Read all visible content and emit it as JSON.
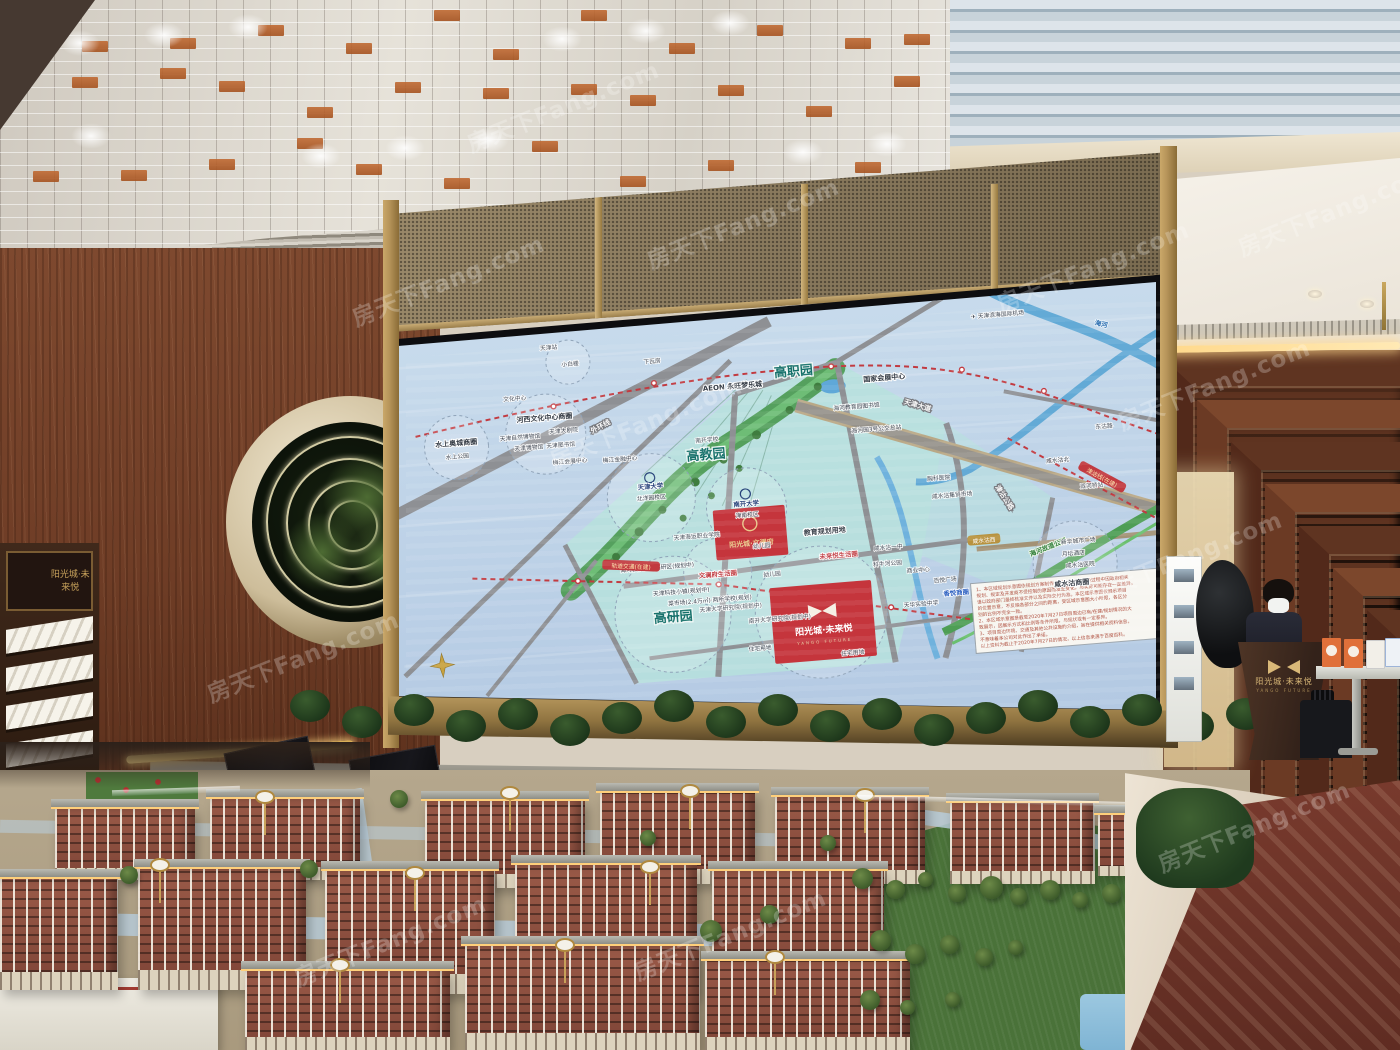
{
  "watermark": {
    "text": "房天下Fang.com"
  },
  "brand": {
    "podium": "阳光城·未来悦",
    "podium_sub": "YANGO FUTURE",
    "rack_plaque": "阳光城·未来悦"
  },
  "screen_map": {
    "projects": {
      "p1": {
        "name": "阳光城·文澜府"
      },
      "p2": {
        "name": "阳光城·未来悦",
        "sub": "YANGO FUTURE"
      }
    },
    "labels": [
      {
        "s": "天津站",
        "x": 150,
        "y": 16,
        "t": "ls"
      },
      {
        "s": "小白楼",
        "x": 170,
        "y": 34,
        "t": "ls"
      },
      {
        "s": "下瓦房",
        "x": 252,
        "y": 38,
        "t": "ls"
      },
      {
        "s": "文化中心",
        "x": 112,
        "y": 64,
        "t": "ls"
      },
      {
        "s": "水上奥城商圈",
        "x": 50,
        "y": 104,
        "t": "ln"
      },
      {
        "s": "水上公园",
        "x": 50,
        "y": 117,
        "t": "ls"
      },
      {
        "s": "河西文化中心商圈",
        "x": 140,
        "y": 86,
        "t": "ln"
      },
      {
        "s": "天津自然博物馆",
        "x": 114,
        "y": 103,
        "t": "ls"
      },
      {
        "s": "天津大剧院",
        "x": 158,
        "y": 100,
        "t": "ls"
      },
      {
        "s": "天津博物馆",
        "x": 122,
        "y": 114,
        "t": "ls"
      },
      {
        "s": "天津图书馆",
        "x": 154,
        "y": 114,
        "t": "ls"
      },
      {
        "s": "梅江会展中心",
        "x": 162,
        "y": 131,
        "t": "ls"
      },
      {
        "s": "梅江金融中心",
        "x": 212,
        "y": 133,
        "t": "ls"
      },
      {
        "s": "外环线",
        "x": 196,
        "y": 99,
        "t": "lroad",
        "r": -23
      },
      {
        "s": "AEON 永旺梦乐城",
        "x": 330,
        "y": 70,
        "t": "ln"
      },
      {
        "s": "高职园",
        "x": 392,
        "y": 62,
        "t": "lz"
      },
      {
        "s": "高教园",
        "x": 298,
        "y": 138,
        "t": "lz"
      },
      {
        "s": "高研园",
        "x": 252,
        "y": 297,
        "t": "lz"
      },
      {
        "s": "✈ 天津滨海国际机场",
        "x": 600,
        "y": 20,
        "t": "ls"
      },
      {
        "s": "国家会展中心",
        "x": 482,
        "y": 74,
        "t": "ln"
      },
      {
        "s": "海河教育园图书馆",
        "x": 452,
        "y": 100,
        "t": "ls"
      },
      {
        "s": "海河园3号公交总站",
        "x": 470,
        "y": 124,
        "t": "ls"
      },
      {
        "s": "天津大道",
        "x": 512,
        "y": 104,
        "t": "lroad",
        "r": 21
      },
      {
        "s": "海河",
        "x": 702,
        "y": 38,
        "t": "lriv",
        "r": 18
      },
      {
        "s": "东沽路",
        "x": 697,
        "y": 140,
        "t": "ls"
      },
      {
        "s": "咸水沽北",
        "x": 648,
        "y": 170,
        "t": "ls"
      },
      {
        "s": "双河桥站",
        "x": 680,
        "y": 198,
        "t": "ls"
      },
      {
        "s": "津沽公路",
        "x": 590,
        "y": 202,
        "t": "lroad",
        "r": 62
      },
      {
        "s": "海河故道公园",
        "x": 632,
        "y": 256,
        "t": "lg",
        "r": -17
      },
      {
        "s": "天津大学",
        "x": 240,
        "y": 163,
        "t": "lu"
      },
      {
        "s": "北洋园校区",
        "x": 240,
        "y": 174,
        "t": "ls"
      },
      {
        "s": "南开大学",
        "x": 334,
        "y": 188,
        "t": "lu"
      },
      {
        "s": "津南校区",
        "x": 334,
        "y": 199,
        "t": "ls"
      },
      {
        "s": "南开学校",
        "x": 300,
        "y": 121,
        "t": "ls"
      },
      {
        "s": "天津海运职业学院",
        "x": 282,
        "y": 216,
        "t": "ls"
      },
      {
        "s": "胸科医院",
        "x": 528,
        "y": 178,
        "t": "ls"
      },
      {
        "s": "咸水沽集贸市场",
        "x": 540,
        "y": 196,
        "t": "ls"
      },
      {
        "s": "海河教育园区高研区(规划中)",
        "x": 240,
        "y": 244,
        "t": "ls"
      },
      {
        "s": "天津科技小镇(规划中)",
        "x": 262,
        "y": 270,
        "t": "ls"
      },
      {
        "s": "天津大学研究院(规划中)",
        "x": 310,
        "y": 290,
        "t": "ls"
      },
      {
        "s": "南开大学研究院(规划中)",
        "x": 358,
        "y": 305,
        "t": "ls"
      },
      {
        "s": "文澜府生活圈",
        "x": 300,
        "y": 256,
        "t": "lr"
      },
      {
        "s": "幼儿园",
        "x": 346,
        "y": 231,
        "t": "ls"
      },
      {
        "s": "幼儿园",
        "x": 354,
        "y": 260,
        "t": "ls"
      },
      {
        "s": "教育规划用地",
        "x": 410,
        "y": 222,
        "t": "ln"
      },
      {
        "s": "未来悦生活圈",
        "x": 422,
        "y": 247,
        "t": "lr"
      },
      {
        "s": "菜市场(2.4万㎡)·两所学校(规划)",
        "x": 290,
        "y": 281,
        "t": "ls"
      },
      {
        "s": "住宅用地",
        "x": 336,
        "y": 333,
        "t": "ls"
      },
      {
        "s": "住宅用地",
        "x": 428,
        "y": 345,
        "t": "ls"
      },
      {
        "s": "咸水沽一中",
        "x": 472,
        "y": 243,
        "t": "ls"
      },
      {
        "s": "科牛河公园",
        "x": 470,
        "y": 259,
        "t": "ls"
      },
      {
        "s": "商业中心",
        "x": 500,
        "y": 268,
        "t": "ls"
      },
      {
        "s": "百悦广场",
        "x": 526,
        "y": 280,
        "t": "ls"
      },
      {
        "s": "天华实验中学",
        "x": 500,
        "y": 302,
        "t": "ls"
      },
      {
        "s": "香悦商圈",
        "x": 536,
        "y": 294,
        "t": "lb"
      },
      {
        "s": "新华城市广场",
        "x": 662,
        "y": 252,
        "t": "ls"
      },
      {
        "s": "月坛酒店",
        "x": 656,
        "y": 264,
        "t": "ls"
      },
      {
        "s": "咸水沽医院",
        "x": 662,
        "y": 276,
        "t": "ls"
      },
      {
        "s": "咸水沽商圈",
        "x": 652,
        "y": 294,
        "t": "ln"
      },
      {
        "s": "咸水沽西",
        "x": 568,
        "y": 243,
        "t": "pg"
      },
      {
        "s": "轨道交通(在建)",
        "x": 214,
        "y": 240,
        "t": "pr",
        "r": 7
      },
      {
        "s": "津沽线(在建)",
        "x": 690,
        "y": 190,
        "t": "pr",
        "r": 33
      }
    ],
    "disclaimer": {
      "lines": [
        "1、本区域规划示意图依规划方案制作，不排除小区建设过程中因政府相关",
        "规划、规定及开发商不受控制的原因而发生变化，与实际可能存在一定差异，",
        "请以政府部门最终核准文件以及实际交付为准。本区域示意图仅展示项目",
        "的位置示意，不反映各部分之间的距离，受区域示意图大小所限，各区分",
        "别的比例不完全一致。",
        "2、本区域示意图是截至2020年7月27日项目周边已有/在建/规划情况的大",
        "致展示，因展示方式和比例等条件所限，与现状或有一定差异。",
        "3、项目周边环境、交通及其他公共设施的介绍，旨在提供相关资料信息，",
        "不意味着本公司对此作出了承诺。",
        "以上资料为截止于2020年7月27日的情况，以上信息来源于百度百科。"
      ]
    }
  }
}
